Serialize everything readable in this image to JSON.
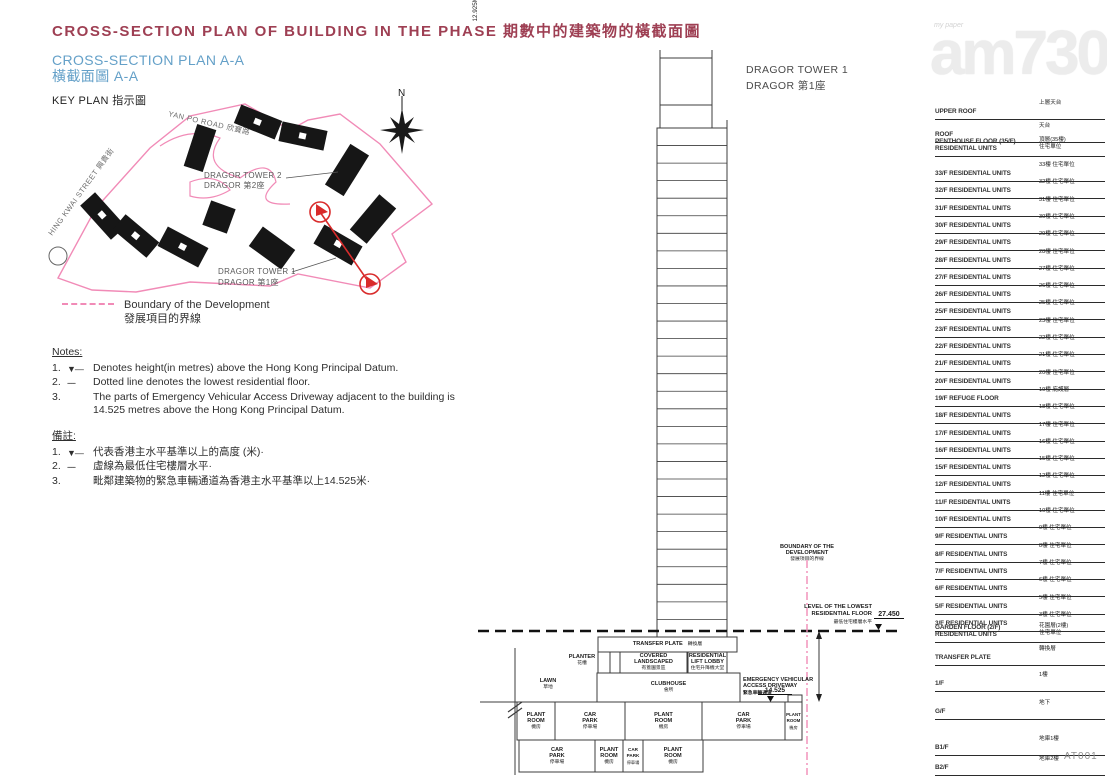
{
  "header": {
    "title": "CROSS-SECTION PLAN OF BUILDING IN THE PHASE 期數中的建築物的橫截面圖",
    "subtitle_en": "CROSS-SECTION PLAN A-A",
    "subtitle_zh": "橫截面圖 A-A",
    "key_plan": "KEY PLAN 指示圖"
  },
  "watermark": {
    "logo": "am730",
    "tagline": "my paper"
  },
  "key_plan": {
    "north": "N",
    "road_top": "YAN PO ROAD 欣寶路",
    "road_left": "HING KWAI STREET 興貴街",
    "tower2_en": "DRAGOR TOWER 2",
    "tower2_zh": "DRAGOR 第2座",
    "tower1_en": "DRAGOR TOWER 1",
    "tower1_zh": "DRAGOR 第1座"
  },
  "legend": {
    "boundary_en": "Boundary of the Development",
    "boundary_zh": "發展項目的界線"
  },
  "notes": {
    "heading": "Notes:",
    "items": [
      {
        "num": "1.",
        "marker": "▼—",
        "text": "Denotes height(in metres) above the Hong Kong Principal Datum."
      },
      {
        "num": "2.",
        "marker": "----",
        "text": "Dotted line denotes the lowest residential floor."
      },
      {
        "num": "3.",
        "marker": "",
        "text": "The parts of Emergency Vehicular Access Driveway adjacent to the building is 14.525 metres above the Hong Kong Principal Datum."
      }
    ]
  },
  "notes_zh": {
    "heading": "備註:",
    "items": [
      {
        "num": "1.",
        "marker": "▼—",
        "text": "代表香港主水平基準以上的高度 (米)·"
      },
      {
        "num": "2.",
        "marker": "----",
        "text": "虛線為最低住宅樓層水平·"
      },
      {
        "num": "3.",
        "marker": "",
        "text": "毗鄰建築物的緊急車輛通道為香港主水平基準以上14.525米·"
      }
    ]
  },
  "section": {
    "tower_label": "DRAGOR TOWER 1\nDRAGOR 第1座",
    "boundary_en": "BOUNDARY OF THE\nDEVELOPMENT",
    "boundary_zh": "發展項目的界線",
    "lowest_en": "LEVEL OF THE LOWEST\nRESIDENTIAL FLOOR",
    "lowest_zh": "最低住宅樓層水平",
    "lowest_value": "27.450",
    "dim": "12.925M(米)",
    "eva_en": "EMERGENCY VEHICULAR\nACCESS DRIVEWAY",
    "eva_zh": "緊急車輛通道",
    "eva_level": "14.525",
    "areas": {
      "transfer_en": "TRANSFER PLATE",
      "transfer_zh": "轉換層",
      "planter_en": "PLANTER",
      "planter_zh": "花槽",
      "covered_en": "COVERED\nLANDSCAPED",
      "covered_zh": "有蓋園景區",
      "lobby_en": "RESIDENTIAL\nLIFT LOBBY",
      "lobby_zh": "住宅升降機大堂",
      "lawn_en": "LAWN",
      "lawn_zh": "草地",
      "clubhouse_en": "CLUBHOUSE",
      "clubhouse_zh": "會所",
      "plant_en": "PLANT\nROOM",
      "plant_zh": "機房",
      "car_en": "CAR\nPARK",
      "car_zh": "停車場"
    }
  },
  "floors": [
    {
      "en": "UPPER ROOF",
      "zh": "上層天台"
    },
    {
      "en": "ROOF",
      "zh": "天台"
    },
    {
      "en": "PENTHOUSE FLOOR (35/F)\nRESIDENTIAL UNITS",
      "zh": "頂層(35樓)\n住宅單位"
    },
    {
      "en": "33/F RESIDENTIAL UNITS",
      "zh": "33樓 住宅單位"
    },
    {
      "en": "32/F RESIDENTIAL UNITS",
      "zh": "32樓 住宅單位"
    },
    {
      "en": "31/F RESIDENTIAL UNITS",
      "zh": "31樓 住宅單位"
    },
    {
      "en": "30/F RESIDENTIAL UNITS",
      "zh": "30樓 住宅單位"
    },
    {
      "en": "29/F RESIDENTIAL UNITS",
      "zh": "29樓 住宅單位"
    },
    {
      "en": "28/F RESIDENTIAL UNITS",
      "zh": "28樓 住宅單位"
    },
    {
      "en": "27/F RESIDENTIAL UNITS",
      "zh": "27樓 住宅單位"
    },
    {
      "en": "26/F RESIDENTIAL UNITS",
      "zh": "26樓 住宅單位"
    },
    {
      "en": "25/F RESIDENTIAL UNITS",
      "zh": "25樓 住宅單位"
    },
    {
      "en": "23/F RESIDENTIAL UNITS",
      "zh": "23樓 住宅單位"
    },
    {
      "en": "22/F RESIDENTIAL UNITS",
      "zh": "22樓 住宅單位"
    },
    {
      "en": "21/F RESIDENTIAL UNITS",
      "zh": "21樓 住宅單位"
    },
    {
      "en": "20/F RESIDENTIAL UNITS",
      "zh": "20樓 住宅單位"
    },
    {
      "en": "19/F REFUGE FLOOR",
      "zh": "19樓 庇護層"
    },
    {
      "en": "18/F RESIDENTIAL UNITS",
      "zh": "18樓 住宅單位"
    },
    {
      "en": "17/F RESIDENTIAL UNITS",
      "zh": "17樓 住宅單位"
    },
    {
      "en": "16/F RESIDENTIAL UNITS",
      "zh": "16樓 住宅單位"
    },
    {
      "en": "15/F RESIDENTIAL UNITS",
      "zh": "15樓 住宅單位"
    },
    {
      "en": "12/F RESIDENTIAL UNITS",
      "zh": "12樓 住宅單位"
    },
    {
      "en": "11/F RESIDENTIAL UNITS",
      "zh": "11樓 住宅單位"
    },
    {
      "en": "10/F RESIDENTIAL UNITS",
      "zh": "10樓 住宅單位"
    },
    {
      "en": "9/F RESIDENTIAL UNITS",
      "zh": "9樓 住宅單位"
    },
    {
      "en": "8/F RESIDENTIAL UNITS",
      "zh": "8樓 住宅單位"
    },
    {
      "en": "7/F RESIDENTIAL UNITS",
      "zh": "7樓 住宅單位"
    },
    {
      "en": "6/F RESIDENTIAL UNITS",
      "zh": "6樓 住宅單位"
    },
    {
      "en": "5/F RESIDENTIAL UNITS",
      "zh": "5樓 住宅單位"
    },
    {
      "en": "3/F RESIDENTIAL UNITS",
      "zh": "3樓 住宅單位"
    },
    {
      "en": "GARDEN FLOOR (2/F)\nRESIDENTIAL UNITS",
      "zh": "花園層(2樓)\n住宅單位"
    },
    {
      "en": "TRANSFER PLATE",
      "zh": "轉換層"
    },
    {
      "en": "1/F",
      "zh": "1樓"
    },
    {
      "en": "G/F",
      "zh": "地下"
    },
    {
      "en": "B1/F",
      "zh": "地庫1樓"
    },
    {
      "en": "B2/F",
      "zh": "地庫2樓"
    }
  ],
  "footer": {
    "code": "AT001"
  },
  "colors": {
    "maroon": "#9e3f53",
    "blue": "#64a0c8",
    "pink": "#f18bb7",
    "red": "#d92b2b",
    "line": "#3c3c3c"
  }
}
